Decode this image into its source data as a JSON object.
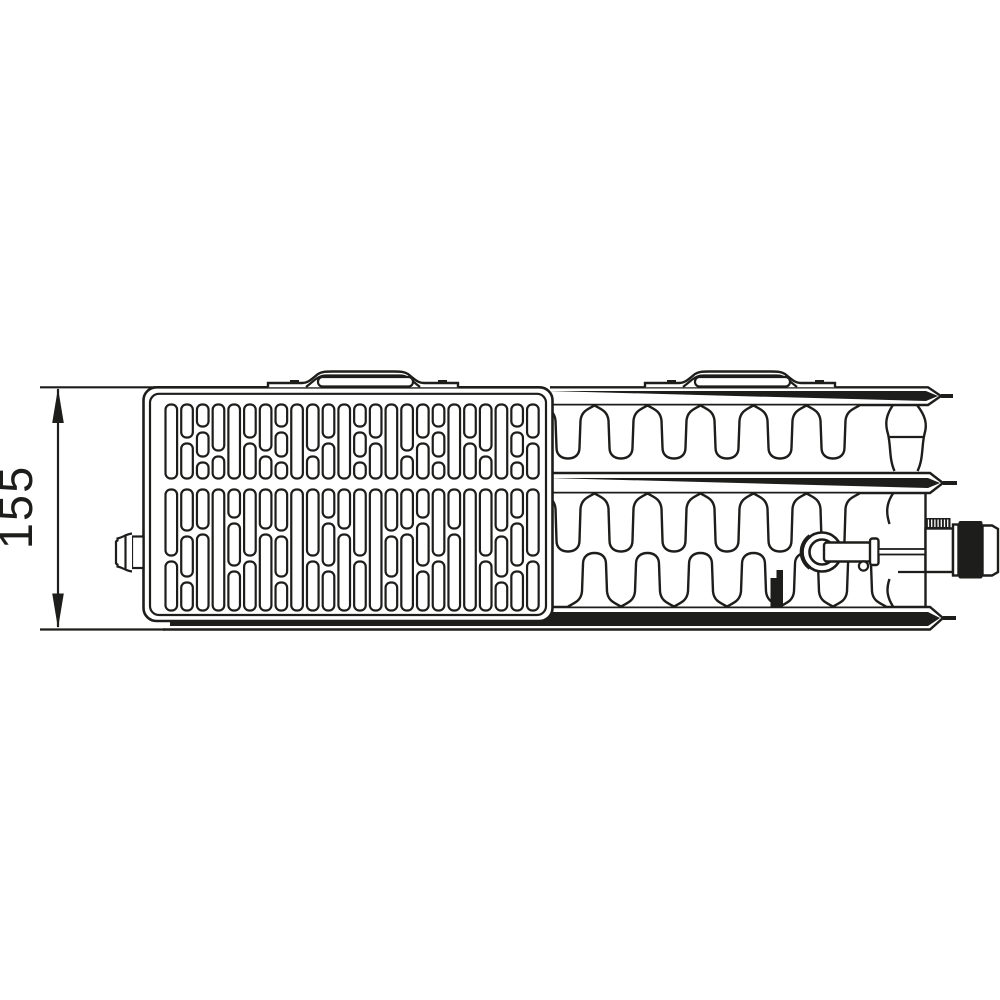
{
  "drawing": {
    "dimension_label": "155"
  },
  "colors": {
    "ink": "#1d1d1b",
    "background": "#ffffff"
  }
}
